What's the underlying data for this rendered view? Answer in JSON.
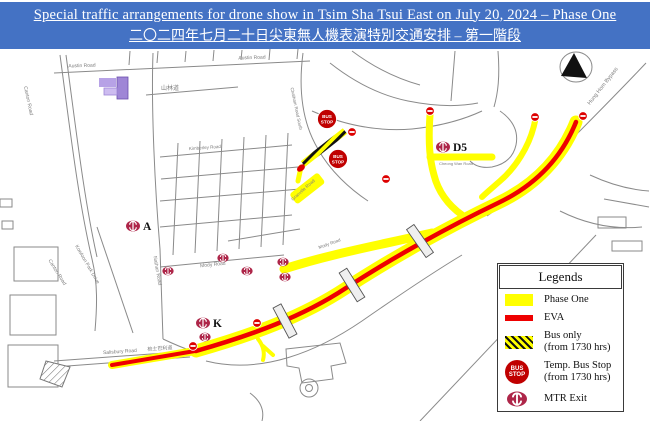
{
  "title": {
    "line1": "Special traffic arrangements for drone show in Tsim Sha Tsui East on July 20, 2024 – Phase One",
    "line2": "二〇二四年七月二十日尖東無人機表演特別交通安排 – 第一階段"
  },
  "colors": {
    "header_bg": "#4472C4",
    "phase_one": "#FFFF00",
    "eva": "#EE0000",
    "temp_bus_stop": "#C00000",
    "mtr": "#AE2649",
    "no_entry": "#DD0000",
    "road": "#8a8a8a",
    "street_label": "#7d7d7d"
  },
  "legend": {
    "title": "Legends",
    "items": [
      {
        "key": "phase-one",
        "label": "Phase One"
      },
      {
        "key": "eva",
        "label": "EVA"
      },
      {
        "key": "bus-only",
        "label": "Bus only",
        "label2": "(from 1730 hrs)"
      },
      {
        "key": "temp-bus-stop",
        "label": "Temp. Bus Stop",
        "label2": "(from 1730 hrs)"
      },
      {
        "key": "mtr-exit",
        "label": "MTR Exit"
      }
    ]
  },
  "map": {
    "bus_stop_text": [
      "BUS",
      "STOP"
    ],
    "street_labels": [
      {
        "text": "Austin Road",
        "x": 82,
        "y": 18,
        "rot": -2,
        "size": 5
      },
      {
        "text": "Austin Road",
        "x": 252,
        "y": 10,
        "rot": -2,
        "size": 5
      },
      {
        "text": "山林道",
        "x": 170,
        "y": 41,
        "rot": 0,
        "size": 6
      },
      {
        "text": "Canton Road",
        "x": 27,
        "y": 52,
        "rot": 78,
        "size": 5
      },
      {
        "text": "Canton Road",
        "x": 56,
        "y": 224,
        "rot": 58,
        "size": 5
      },
      {
        "text": "Kowloon Park Drive",
        "x": 86,
        "y": 216,
        "rot": 60,
        "size": 5
      },
      {
        "text": "Nathan Road",
        "x": 156,
        "y": 222,
        "rot": 80,
        "size": 5
      },
      {
        "text": "Mody Road",
        "x": 213,
        "y": 217,
        "rot": -6,
        "size": 5
      },
      {
        "text": "Salisbury Road",
        "x": 120,
        "y": 304,
        "rot": -4,
        "size": 5
      },
      {
        "text": "梳士巴利道",
        "x": 160,
        "y": 301,
        "rot": -4,
        "size": 5
      },
      {
        "text": "Hung Hom Bypass",
        "x": 604,
        "y": 38,
        "rot": -52,
        "size": 5.5
      },
      {
        "text": "Chatham Road South",
        "x": 295,
        "y": 60,
        "rot": 78,
        "size": 4.5
      },
      {
        "text": "Kimberley Road",
        "x": 205,
        "y": 100,
        "rot": -4,
        "size": 4.5
      },
      {
        "text": "Granville Road",
        "x": 304,
        "y": 142,
        "rot": -42,
        "size": 4.5
      },
      {
        "text": "Cheong Wan Road",
        "x": 456,
        "y": 116,
        "rot": 0,
        "size": 4
      },
      {
        "text": "Mody Road",
        "x": 330,
        "y": 196,
        "rot": -20,
        "size": 4.5
      }
    ],
    "mtr_exits": [
      {
        "x": 133,
        "y": 177,
        "label": "A"
      },
      {
        "x": 203,
        "y": 274,
        "label": "K"
      },
      {
        "x": 443,
        "y": 98,
        "label": "D5"
      },
      {
        "x": 168,
        "y": 222
      },
      {
        "x": 223,
        "y": 209
      },
      {
        "x": 247,
        "y": 222
      },
      {
        "x": 283,
        "y": 213
      },
      {
        "x": 285,
        "y": 228
      },
      {
        "x": 205,
        "y": 288
      }
    ],
    "bus_stops": [
      {
        "x": 327,
        "y": 70
      },
      {
        "x": 338,
        "y": 110
      }
    ],
    "no_entry": [
      {
        "x": 352,
        "y": 83
      },
      {
        "x": 430,
        "y": 62
      },
      {
        "x": 535,
        "y": 68
      },
      {
        "x": 583,
        "y": 67
      },
      {
        "x": 386,
        "y": 130
      },
      {
        "x": 257,
        "y": 274
      },
      {
        "x": 193,
        "y": 297
      }
    ],
    "footbridges": [
      {
        "x": 285,
        "y": 272,
        "rot": 62
      },
      {
        "x": 352,
        "y": 236,
        "rot": 58
      },
      {
        "x": 420,
        "y": 192,
        "rot": 55
      }
    ]
  }
}
